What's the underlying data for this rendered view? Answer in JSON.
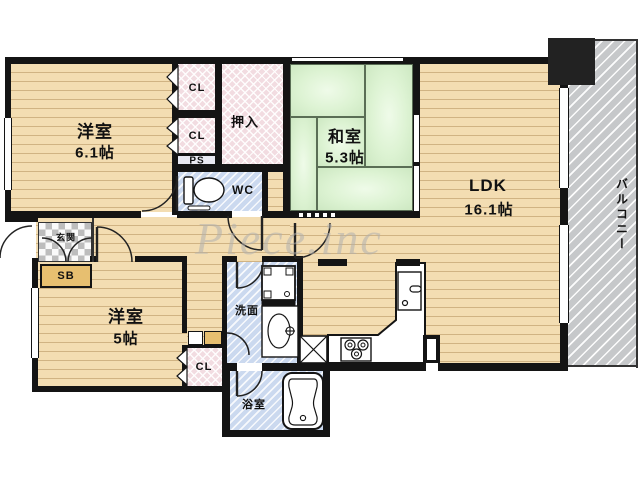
{
  "watermark": "Piece.inc",
  "rooms": {
    "western1": {
      "name": "洋室",
      "size": "6.1帖"
    },
    "western2": {
      "name": "洋室",
      "size": "5帖"
    },
    "japanese": {
      "name": "和室",
      "size": "5.3帖"
    },
    "ldk": {
      "name": "LDK",
      "size": "16.1帖"
    },
    "balcony": {
      "name": "バルコニー"
    },
    "entrance": {
      "name": "玄関"
    },
    "washroom": {
      "name": "洗面"
    },
    "bathroom": {
      "name": "浴室"
    },
    "toilet": {
      "name": "WC"
    },
    "oshiire": {
      "name": "押入"
    },
    "closet1": {
      "name": "CL"
    },
    "closet2": {
      "name": "CL"
    },
    "closet3": {
      "name": "CL"
    },
    "pipe_space": {
      "name": "PS"
    },
    "shoe_box": {
      "name": "SB"
    }
  },
  "colors": {
    "wall": "#141414",
    "wood_floor": "#f3ddb2",
    "tatami": "#ddf3d3",
    "wet_area": "#cbd9ef",
    "closet": "#f2dce1",
    "balcony": "#c6c8ca",
    "shoe_box": "#e7bf70"
  }
}
